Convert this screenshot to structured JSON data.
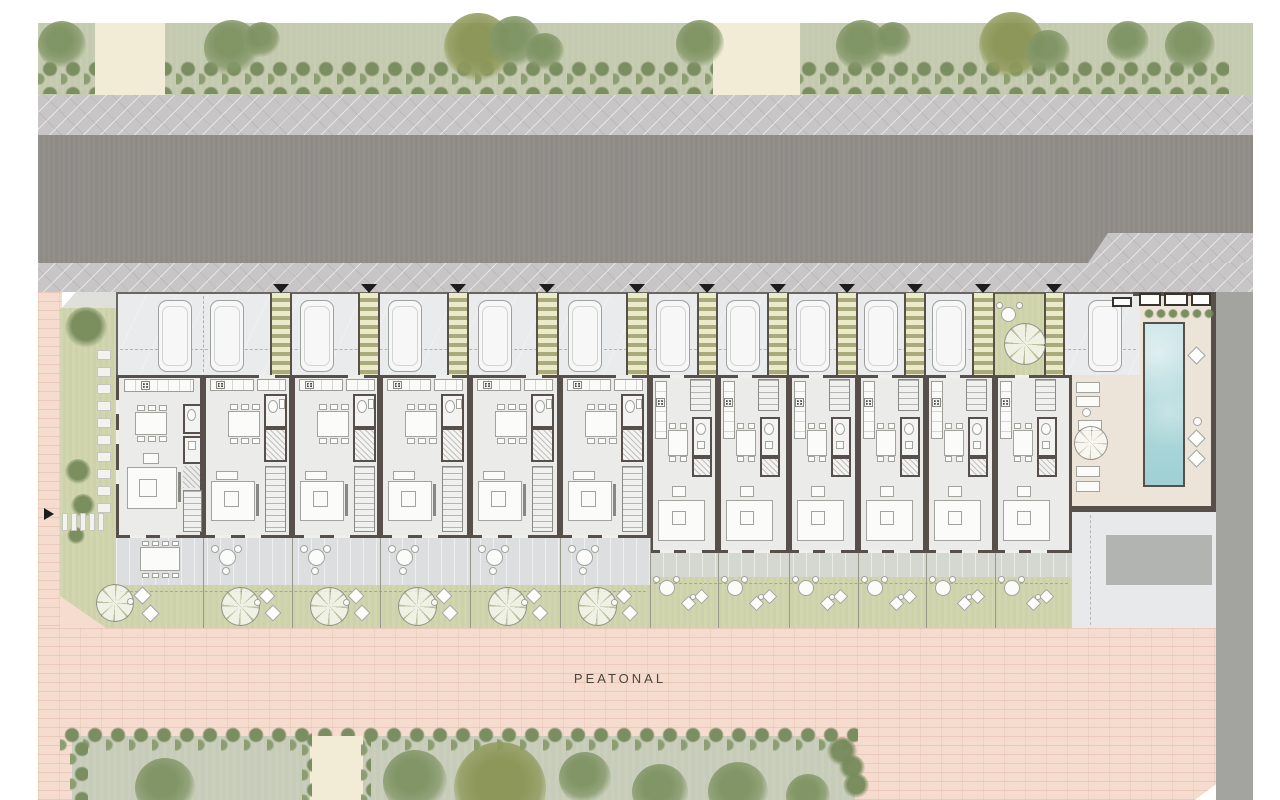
{
  "labels": {
    "pedestrian_street": "PEATONAL"
  },
  "palette": {
    "wall": "#57504a",
    "floor": "#ebebe9",
    "green_garden": "#cdd2a9",
    "pink": "#f5dccf",
    "hedge": "#7b8e61",
    "grass_park": "#c7ccb9",
    "road": "#8f8c88",
    "sidewalk": "#c8c5c7",
    "garage_floor": "#e9ebec",
    "terrace": "#dcdee0",
    "pool_blue": "#aed7da",
    "deck_cream": "#ece4d8",
    "cream_path": "#f2ecd6",
    "top_grass": "#c4caaf",
    "right_road": "#a3a3a0",
    "plaza_gray": "#e8e9eb",
    "ramp_gray": "#b2b4b1",
    "text": "#4b453e"
  },
  "plan": {
    "units": [
      {
        "id": "01",
        "type": "end",
        "x": 116,
        "x2": 203
      },
      {
        "id": "02",
        "type": "wide",
        "x": 203,
        "x2": 292
      },
      {
        "id": "03",
        "type": "wide",
        "x": 292,
        "x2": 380
      },
      {
        "id": "04",
        "type": "wide",
        "x": 380,
        "x2": 470
      },
      {
        "id": "05",
        "type": "wide",
        "x": 470,
        "x2": 560
      },
      {
        "id": "06",
        "type": "wide",
        "x": 560,
        "x2": 650
      },
      {
        "id": "07",
        "type": "narrow",
        "x": 650,
        "x2": 718
      },
      {
        "id": "08",
        "type": "narrow",
        "x": 718,
        "x2": 789
      },
      {
        "id": "09",
        "type": "narrow",
        "x": 789,
        "x2": 858
      },
      {
        "id": "10",
        "type": "narrow",
        "x": 858,
        "x2": 926
      },
      {
        "id": "11",
        "type": "narrow",
        "x": 926,
        "x2": 995
      },
      {
        "id": "12",
        "type": "narrow",
        "x": 995,
        "x2": 1072,
        "courtyard": true
      }
    ],
    "pergolas": [
      [
        270,
        22
      ],
      [
        358,
        22
      ],
      [
        447,
        22
      ],
      [
        536,
        23
      ],
      [
        626,
        23
      ],
      [
        697,
        21
      ],
      [
        767,
        22
      ],
      [
        836,
        22
      ],
      [
        904,
        22
      ],
      [
        972,
        23
      ],
      [
        1044,
        21
      ]
    ],
    "entry_arrows": [
      281,
      369,
      458,
      547,
      637,
      707,
      778,
      847,
      915,
      983,
      1054
    ],
    "cars": [
      158,
      210,
      300,
      388,
      478,
      568,
      656,
      726,
      796,
      864,
      932,
      1088
    ],
    "garage_dividers": [
      203
    ],
    "garden_dividers_left": [
      203,
      292,
      380,
      470,
      560,
      650
    ],
    "garden_dividers_right": [
      718,
      789,
      858,
      926,
      995
    ],
    "top_trees": [
      [
        62,
        45,
        24
      ],
      [
        232,
        48,
        28
      ],
      [
        262,
        40,
        18
      ],
      [
        478,
        47,
        34,
        1
      ],
      [
        515,
        42,
        26
      ],
      [
        545,
        52,
        19
      ],
      [
        700,
        44,
        24
      ],
      [
        862,
        46,
        26
      ],
      [
        893,
        40,
        18
      ],
      [
        1012,
        45,
        33,
        1
      ],
      [
        1048,
        52,
        22
      ],
      [
        1128,
        42,
        21
      ],
      [
        1190,
        46,
        25
      ]
    ],
    "park_trees": [
      [
        165,
        788,
        30
      ],
      [
        415,
        782,
        32
      ],
      [
        500,
        788,
        46,
        1
      ],
      [
        585,
        778,
        26
      ],
      [
        660,
        792,
        28
      ],
      [
        738,
        792,
        30
      ],
      [
        808,
        796,
        22
      ]
    ],
    "park_hedge_blobs": [
      [
        842,
        752,
        15
      ],
      [
        852,
        768,
        13
      ],
      [
        856,
        786,
        13
      ]
    ],
    "west_bushes": [
      [
        86,
        328,
        21
      ],
      [
        78,
        472,
        13
      ],
      [
        83,
        506,
        12
      ],
      [
        76,
        536,
        9
      ]
    ],
    "stepping_stones_v": {
      "x": 97,
      "y0": 350,
      "count": 10,
      "dy": 17,
      "w": 14,
      "h": 10
    },
    "stepping_stones_h": {
      "x0": 62,
      "y": 513,
      "count": 5,
      "dx": 9,
      "w": 6,
      "h": 18
    },
    "west_arrow": [
      44,
      508
    ],
    "courtyard_items": {
      "table": [
        1001,
        307,
        15
      ],
      "chairs": [
        [
          996,
          302
        ],
        [
          1016,
          302
        ]
      ],
      "tree": [
        1004,
        323,
        42
      ]
    },
    "amenity": {
      "car": 1088,
      "windows": [
        [
          1112,
          297,
          20,
          10
        ],
        [
          1139,
          293,
          22,
          13
        ],
        [
          1164,
          293,
          24,
          13
        ],
        [
          1191,
          293,
          20,
          13
        ]
      ],
      "planter": {
        "x0": 1144,
        "y": 309,
        "n": 6,
        "dx": 12,
        "d": 10
      },
      "cushions": [
        [
          1190,
          349
        ],
        [
          1190,
          432
        ],
        [
          1190,
          452
        ]
      ],
      "pouf": [
        1193,
        417
      ],
      "loungers": [
        [
          1076,
          382
        ],
        [
          1076,
          396
        ],
        [
          1078,
          420
        ],
        [
          1076,
          466
        ],
        [
          1076,
          481
        ]
      ],
      "side_table": [
        1082,
        408
      ],
      "tree": [
        1074,
        426,
        34
      ]
    }
  }
}
